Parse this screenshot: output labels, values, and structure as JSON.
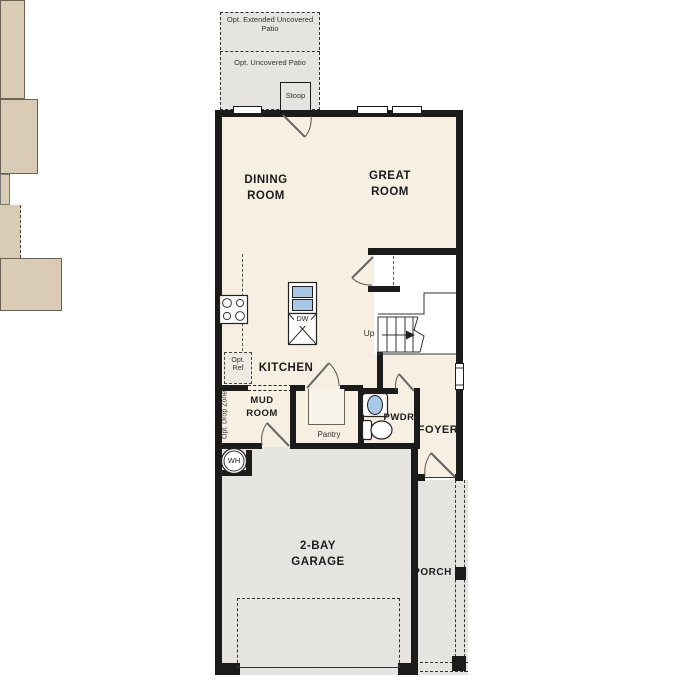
{
  "title": "Two-story home first floor plan",
  "colors": {
    "wall": "#1b1b1b",
    "interior": "#f6efe2",
    "counter": "#d9cbb4",
    "concrete": "#e5e4e1",
    "fixture_blue": "#a9c7e6"
  },
  "labels": {
    "patio_extended": "Opt. Extended Uncovered Patio",
    "patio": "Opt. Uncovered Patio",
    "stoop": "Stoop",
    "dining": "DINING ROOM",
    "great": "GREAT ROOM",
    "kitchen": "KITCHEN",
    "mud": "MUD ROOM",
    "pantry": "Pantry",
    "pwdr": "PWDR",
    "foyer": "FOYER",
    "garage": "2-BAY GARAGE",
    "porch": "PORCH",
    "up": "Up",
    "dw": "DW",
    "wh": "WH",
    "opt_ref": "Opt. Ref",
    "opt_drop": "Opt. Drop Zone"
  }
}
